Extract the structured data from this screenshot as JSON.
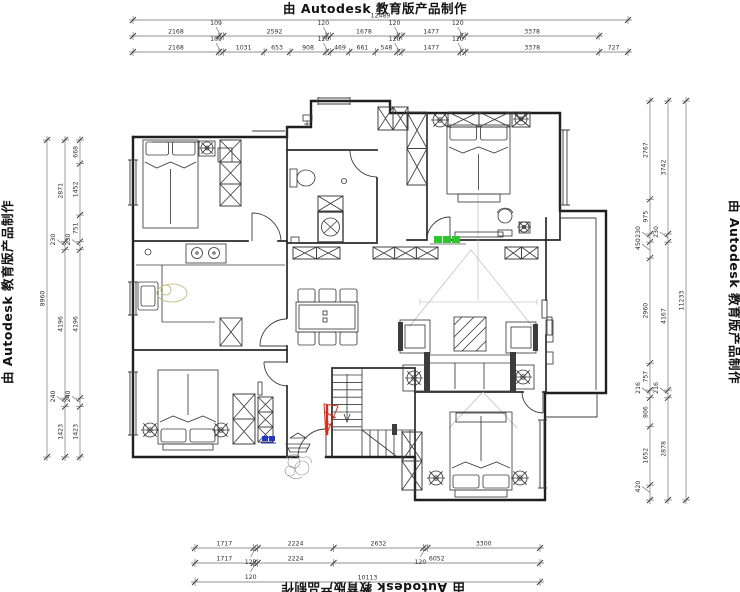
{
  "watermark": {
    "top": "由 Autodesk 教育版产品制作",
    "bottom": "由 Autodesk 教育版产品制作",
    "left": "由 Autodesk 教育版产品制作",
    "right": "由 Autodesk 教育版产品制作"
  },
  "dimensions": {
    "top": {
      "overall": [
        "12489"
      ],
      "row1": [
        "2168",
        "109",
        "2592",
        "120",
        "1678",
        "120",
        "1477",
        "120",
        "3378"
      ],
      "row2": [
        "2168",
        "109",
        "1031",
        "653",
        "908",
        "120",
        "469",
        "661",
        "548",
        "120",
        "1477",
        "120",
        "3378",
        "727"
      ]
    },
    "left": {
      "overall": [
        "8960"
      ],
      "mid": [
        "2871",
        "230",
        "4196",
        "240",
        "1423"
      ],
      "inner": [
        "668",
        "1452",
        "751",
        "230",
        "4196",
        "240",
        "1423"
      ]
    },
    "right": {
      "inner": [
        "2767",
        "975",
        "230",
        "450",
        "2960",
        "757",
        "216",
        "806",
        "1652",
        "420"
      ],
      "mid": [
        "3742",
        "230",
        "4167",
        "216",
        "2878"
      ],
      "overall": [
        "11233"
      ]
    },
    "bottom": {
      "row1": [
        "1717",
        "120",
        "2224",
        "2632",
        "120",
        "3300"
      ],
      "row2": [
        "1717",
        "120",
        "2224",
        "6052"
      ],
      "overall": [
        "10113"
      ]
    }
  },
  "annotations": {
    "red_marker_color": "#d92b1c",
    "green_marker_color": "#2ec82e",
    "blue_marker_color": "#2236cc"
  }
}
